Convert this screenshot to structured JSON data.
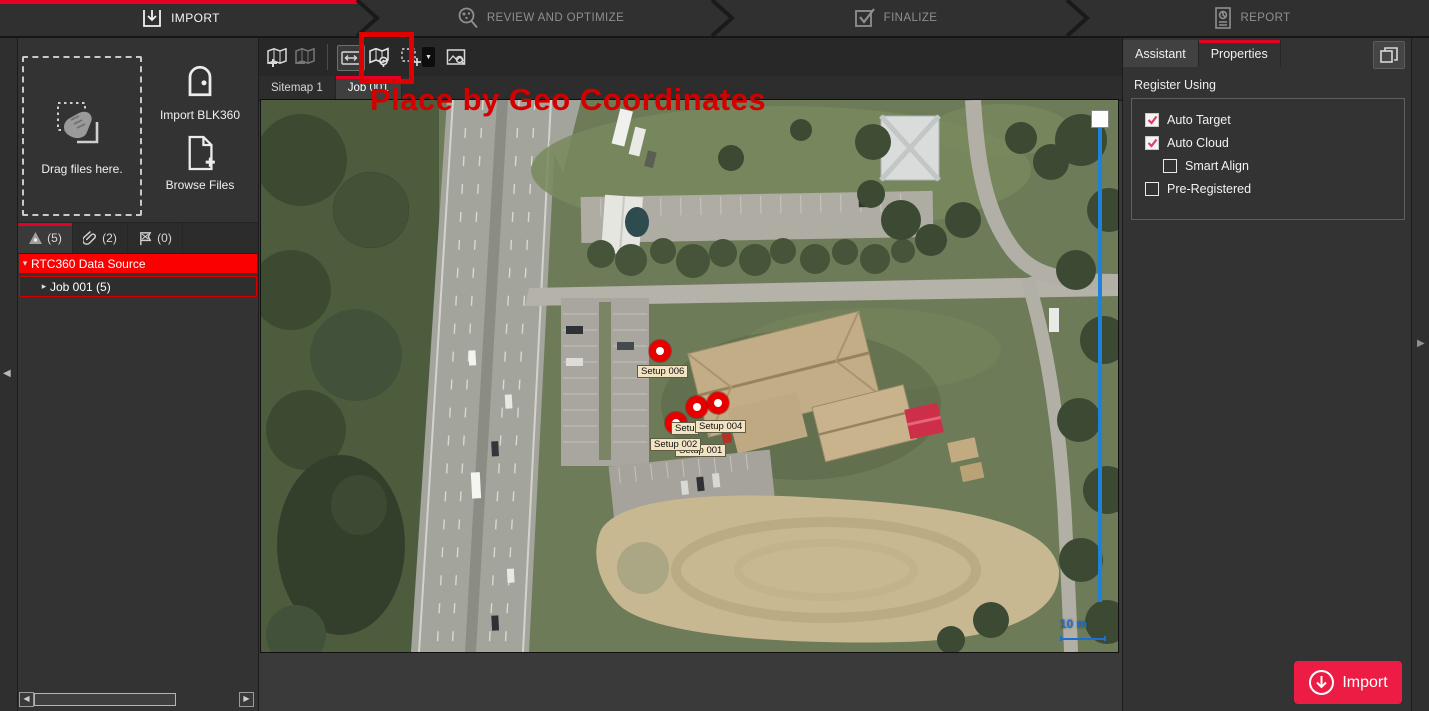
{
  "workflow": {
    "steps": [
      {
        "label": "IMPORT",
        "active": true
      },
      {
        "label": "REVIEW AND OPTIMIZE",
        "active": false
      },
      {
        "label": "FINALIZE",
        "active": false
      },
      {
        "label": "REPORT",
        "active": false
      }
    ]
  },
  "left_panel": {
    "drop_label": "Drag files here.",
    "import_blk360_label": "Import BLK360",
    "browse_files_label": "Browse Files",
    "tabs": [
      {
        "icon": "targets-icon",
        "count": "(5)",
        "active": true
      },
      {
        "icon": "links-icon",
        "count": "(2)",
        "active": false
      },
      {
        "icon": "constraints-icon",
        "count": "(0)",
        "active": false
      }
    ],
    "tree": {
      "root_label": "RTC360 Data Source",
      "child_label": "Job 001 (5)"
    }
  },
  "viewer": {
    "tabs": [
      {
        "label": "Sitemap 1",
        "active": false
      },
      {
        "label": "Job 001",
        "active": true
      }
    ],
    "markers": [
      {
        "label": "Setup 006"
      },
      {
        "label": "Setup 004"
      },
      {
        "label": "Setup 002"
      },
      {
        "label": "Setup 001",
        "note": "partially occluded by Setup 002 label"
      },
      {
        "label_partial": "Setu",
        "note": "label occluded by Setup 004 label"
      }
    ],
    "scale_label": "10 m"
  },
  "annotation": {
    "text": "Place by Geo Coordinates",
    "color": "#d40000"
  },
  "right_panel": {
    "tabs": [
      {
        "label": "Assistant",
        "active": false
      },
      {
        "label": "Properties",
        "active": true
      }
    ],
    "section_title": "Register Using",
    "options": [
      {
        "label": "Auto Target",
        "checked": true,
        "indent": false
      },
      {
        "label": "Auto Cloud",
        "checked": true,
        "indent": false
      },
      {
        "label": "Smart Align",
        "checked": false,
        "indent": true
      },
      {
        "label": "Pre-Registered",
        "checked": false,
        "indent": false
      }
    ]
  },
  "footer": {
    "import_label": "Import"
  },
  "colors": {
    "accent_red": "#e80024",
    "selection_red": "#fb0000",
    "annotation_red": "#d40000",
    "scale_blue": "#1b6fd0",
    "import_button_red": "#ec1c45"
  }
}
